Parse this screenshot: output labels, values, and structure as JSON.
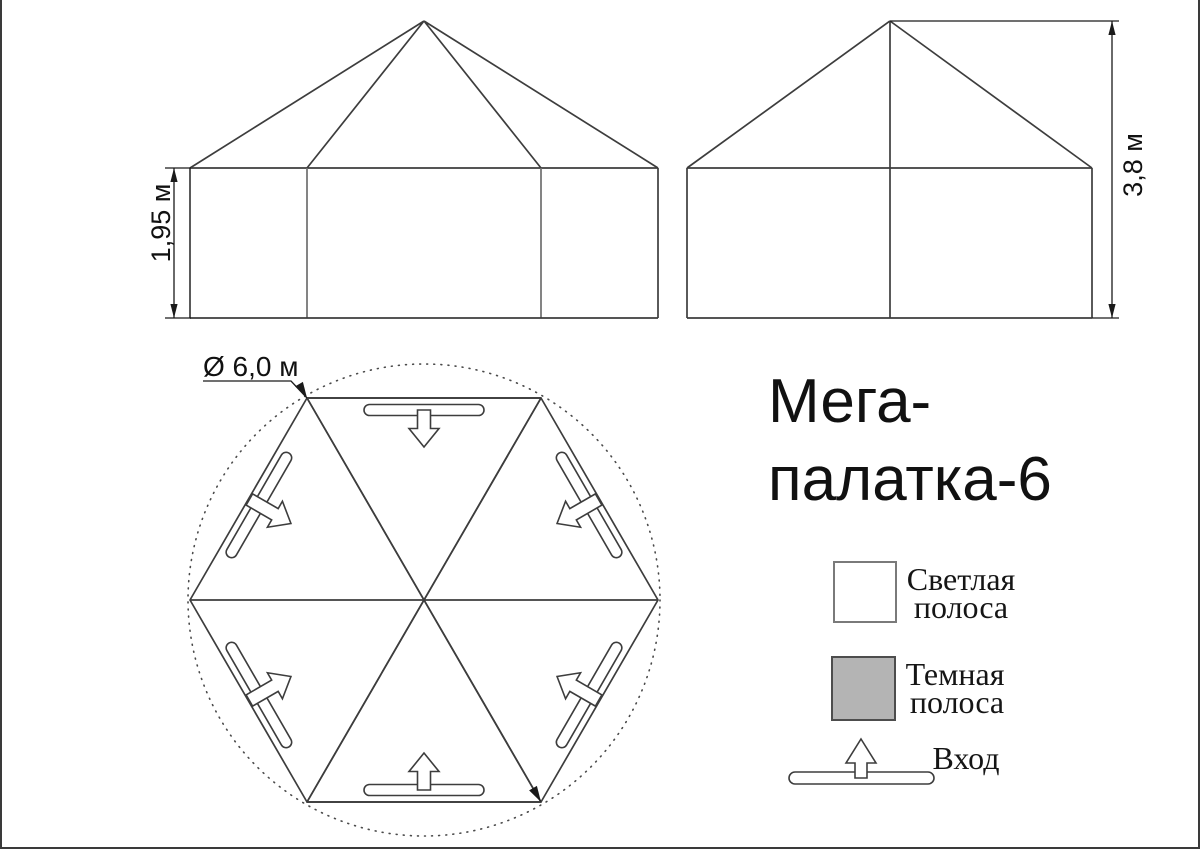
{
  "page": {
    "background": "#ffffff",
    "border_color": "#3a3a3a"
  },
  "title": {
    "line1": "Мега-",
    "line2": "палатка-6"
  },
  "dimensions": {
    "wall_height": "1,95 м",
    "total_height": "3,8 м",
    "diameter": "Ø 6,0 м"
  },
  "colors": {
    "light_stripe": "#ffffff",
    "dark_stripe": "#b4b4b4",
    "outline": "#3d3d3d",
    "dim_line": "#1a1a1a"
  },
  "legend": {
    "items": [
      {
        "swatch": "light-square",
        "line1": "Светлая",
        "line2": "полоса"
      },
      {
        "swatch": "dark-square",
        "line1": "Темная",
        "line2": "полоса"
      },
      {
        "swatch": "entrance-symbol",
        "label": "Вход"
      }
    ]
  },
  "icons": {
    "entrance_arrow": "hollow-arrow-through-door-slot",
    "diameter_symbol": "Ø",
    "dimension_arrow": "filled-triangle"
  }
}
